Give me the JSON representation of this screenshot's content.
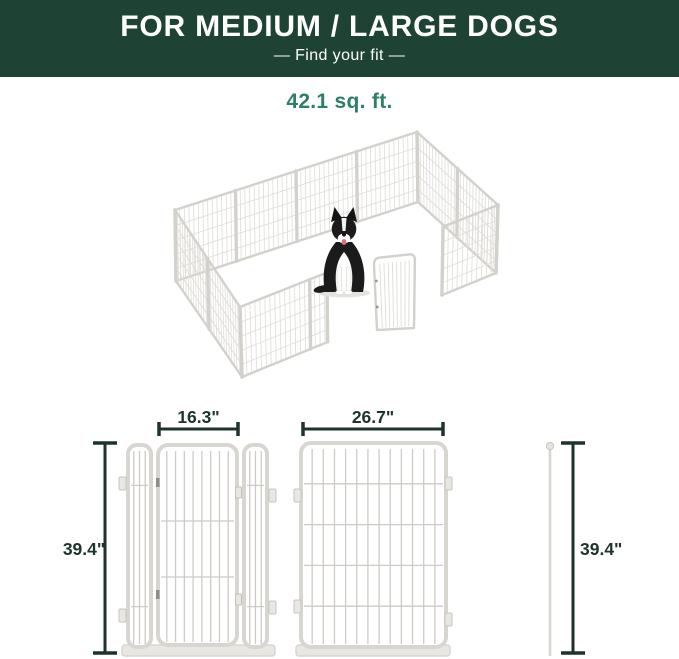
{
  "banner": {
    "title": "FOR MEDIUM / LARGE DOGS",
    "subtitle": "—  Find your fit  —"
  },
  "area_label": "42.1 sq. ft.",
  "illustration": {
    "subject": "white metal dog playpen, rectangular, gate open, border collie sitting inside"
  },
  "dimensions": {
    "door_unit_width": "16.3\"",
    "door_unit_height": "39.4\"",
    "panel_width": "26.7\"",
    "panel_height": "39.4\""
  },
  "colors": {
    "banner_bg": "#1e4334",
    "banner_fg": "#ffffff",
    "area_fg": "#2e8063",
    "dim_fg": "#1d332b",
    "pen_frame": "#d3d1cc",
    "pen_mesh": "#dedcd7",
    "diagram_frame": "#d8d6d1",
    "diagram_mesh": "#cecbc6"
  }
}
